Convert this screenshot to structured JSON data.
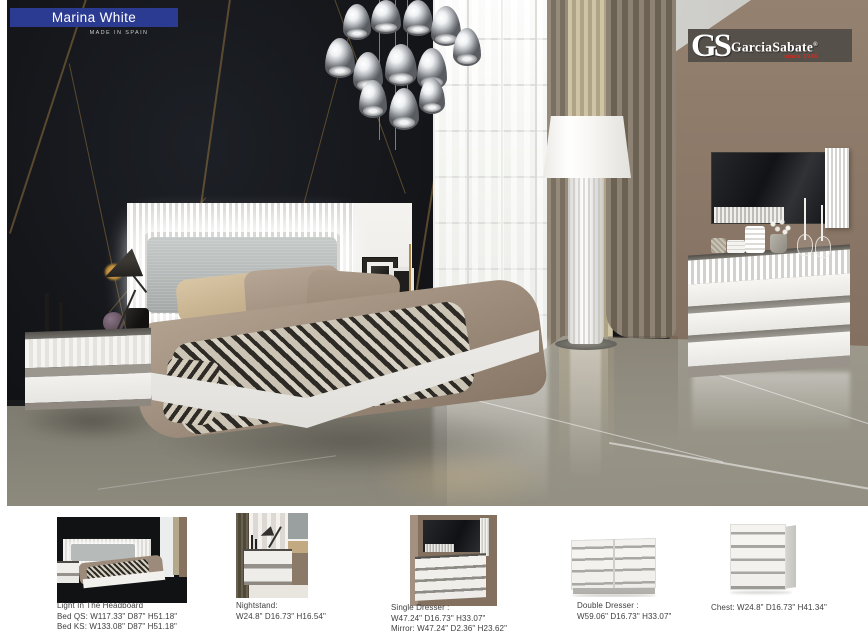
{
  "header": {
    "title": "Marina White",
    "subtitle": "MADE IN SPAIN",
    "accent_color": "#2c3b92"
  },
  "logo": {
    "monogram": "GS",
    "brand": "GarciaSabate",
    "registered": "®",
    "tagline": "since 1946",
    "tagline_color": "#d42b20",
    "box_color": "#56504a"
  },
  "products": [
    {
      "name": "Bed",
      "lines": [
        "Light In The Headboard",
        "Bed QS: W117.33\" D87\" H51.18\"",
        "Bed KS: W133.08\" D87\" H51.18\""
      ]
    },
    {
      "name": "Nightstand",
      "lines": [
        "Nightstand:",
        "W24.8\" D16.73\" H16.54\""
      ]
    },
    {
      "name": "Single Dresser",
      "lines": [
        "Single Dresser :",
        "W47.24\" D16.73\" H33.07\"",
        "Mirror: W47.24\" D2.36\" H23.62\""
      ]
    },
    {
      "name": "Double Dresser",
      "lines": [
        "Double Dresser :",
        "W59.06\" D16.73\" H33.07\""
      ]
    },
    {
      "name": "Chest",
      "lines": [
        "Chest: W24.8\" D16.73\" H41.34\""
      ]
    }
  ]
}
